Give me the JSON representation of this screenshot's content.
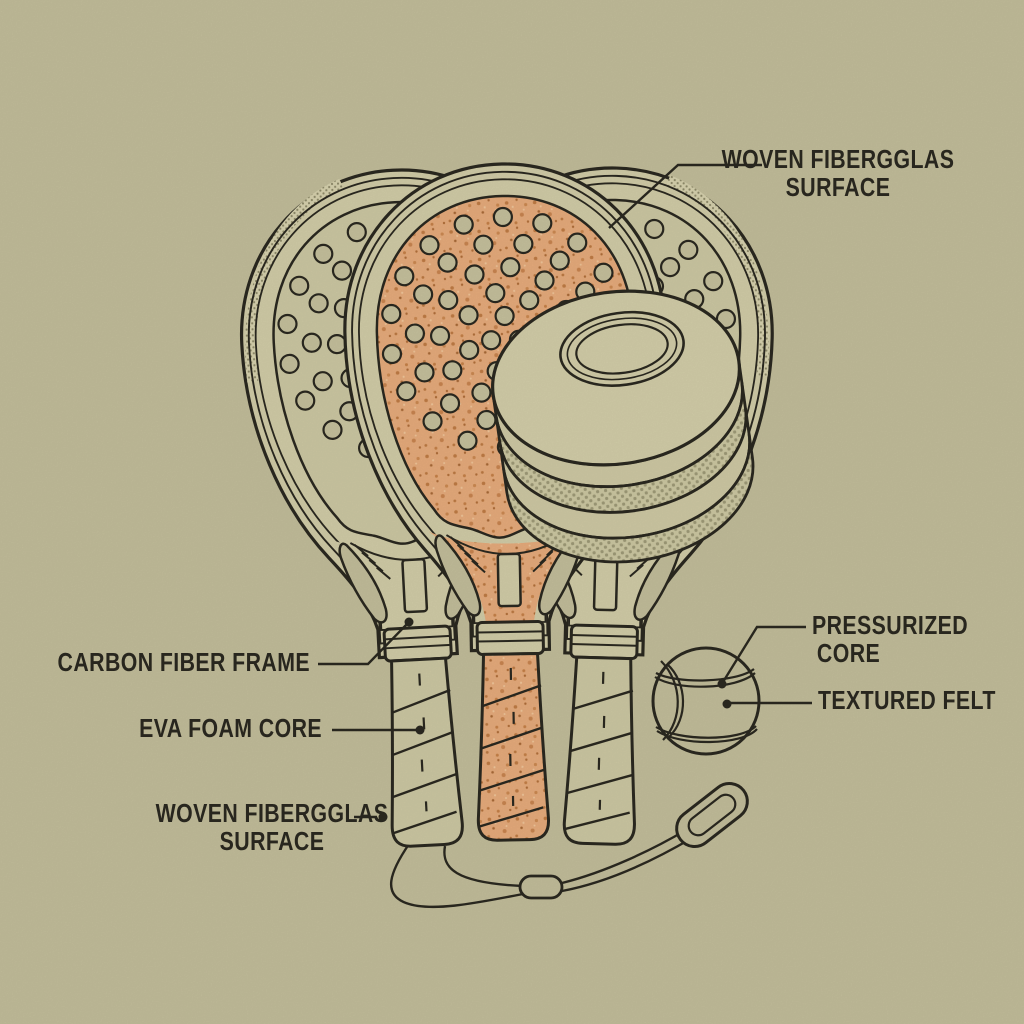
{
  "illustration": {
    "kind": "padel racket construction diagram"
  },
  "labels": {
    "fiberglass_top": {
      "line1": "WOVEN FIBERGGLAS",
      "line2": "SURFACE"
    },
    "carbon_frame": {
      "text": "CARBON FIBER FRAME"
    },
    "eva_core": {
      "text": "EVA FOAM CORE"
    },
    "fiberglass_bottom": {
      "line1": "WOVEN FIBERGGLAS",
      "line2": "SURFACE"
    },
    "pressurized_core": {
      "line1": "PRESSURIZED",
      "line2": "CORE"
    },
    "textured_felt": {
      "text": "TEXTURED FELT"
    }
  },
  "colors": {
    "background": "#c3be9b",
    "ink": "#2b2920",
    "khaki_surface": "#cdc8a3",
    "frame": "#d2cda8",
    "hole": "#c6c19d",
    "orange_core": "#e7ac7c",
    "disc_face": "#d3cea9"
  }
}
